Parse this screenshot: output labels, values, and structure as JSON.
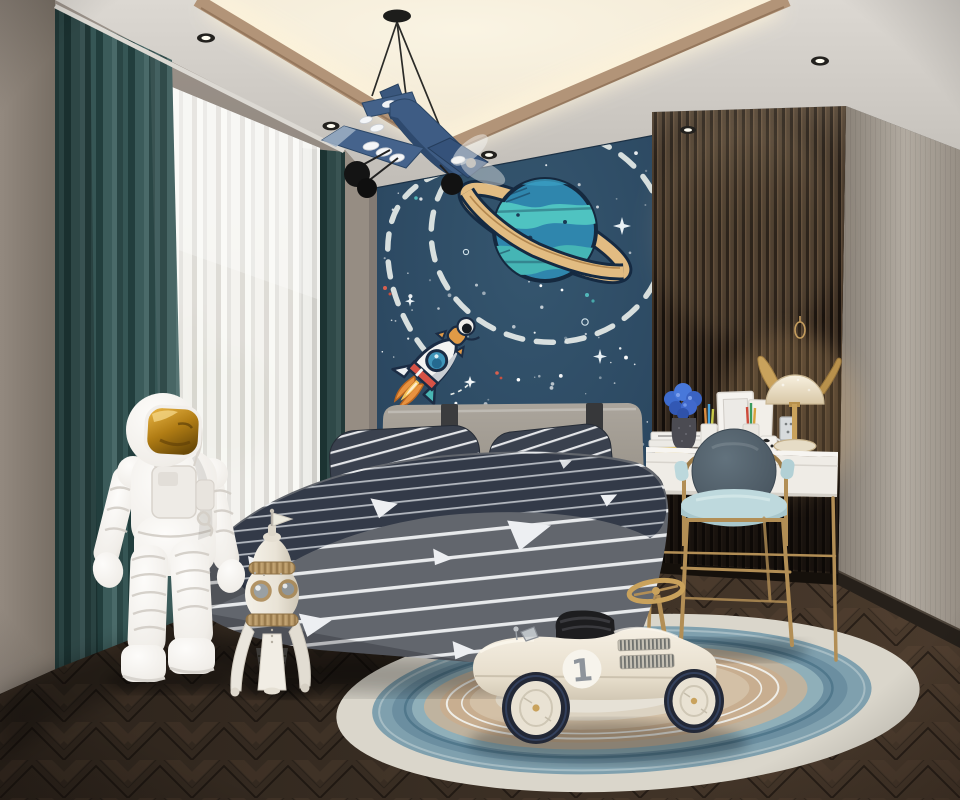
{
  "scene": {
    "type": "interior-3d-render",
    "title": "Space-themed children's bedroom",
    "description": "3D render of a kids bedroom: navy space mural with ringed planet and cartoon rocket behind a grey bed with striped bedding, life-size white astronaut statue with gold visor, cream toy rocket, vintage cream ride-on race car numbered 1 on an oval ringed rug, blue toy-airplane pendant lamp, dark teal and sheer curtains, walnut wood-slat feature wall with white desk, horned mushroom lamp and round-back chair, dark herringbone wood floor, tray ceiling with warm cove lighting.",
    "car": {
      "race_number": "1"
    },
    "mural": {
      "stars": {
        "count": 95,
        "color": "#ffffff"
      }
    },
    "palette": {
      "mural_navy": "#2d4b63",
      "planet_blue": "#2f86ad",
      "planet_teal": "#4fc3c1",
      "ring_tan": "#e2bc82",
      "curtain_teal": "#30504f",
      "sheer_white": "#f2f0ec",
      "slat_walnut": "#413326",
      "left_wall_beige": "#8a8177",
      "right_wall_grey": "#a39c92",
      "ceiling_cream": "#f2ebdb",
      "trim_tan": "#b29478",
      "headboard_grey": "#a09a91",
      "pillow_navy": "#3a414e",
      "duvet_grey": "#62666d",
      "astronaut_white": "#f7f5f2",
      "visor_gold": "#c2861c",
      "car_cream": "#ece4d4",
      "tire_navy": "#232836",
      "frame_gold": "#b28e55",
      "chair_disc_slate": "#53636f",
      "cushion_blue": "#bed9dd",
      "rug_blue": "#6b8ea0",
      "rug_tan": "#c8ae90",
      "floor_brown": "#3b2f26",
      "hydrangea_blue": "#4169cc"
    },
    "objects": [
      {
        "id": "ceiling-cove",
        "label": "Recessed tray ceiling with warm cove light and tan trim"
      },
      {
        "id": "downlights",
        "label": "Recessed ceiling downlights",
        "count": 5
      },
      {
        "id": "airplane-pendant",
        "label": "Blue toy-airplane pendant lamp on black ceiling mount"
      },
      {
        "id": "space-mural",
        "label": "Navy space wall mural with stars and dashed orbits"
      },
      {
        "id": "saturn-planet",
        "label": "Hand-drawn ringed planet with teal bands and tan ring"
      },
      {
        "id": "mural-rocket",
        "label": "Cartoon rocket with riding astronaut and orange flames"
      },
      {
        "id": "teal-curtain-left",
        "label": "Dark teal blackout curtain"
      },
      {
        "id": "sheer-curtain",
        "label": "White sheer curtain over bright window"
      },
      {
        "id": "teal-curtain-right",
        "label": "Dark teal curtain panel beside mural"
      },
      {
        "id": "left-wall",
        "label": "Beige side wall"
      },
      {
        "id": "slat-wall",
        "label": "Dark walnut vertical wood-slat feature wall"
      },
      {
        "id": "right-wall",
        "label": "Grey fabric side wall with dark baseboard"
      },
      {
        "id": "headboard",
        "label": "Grey upholstered headboard with charcoal straps"
      },
      {
        "id": "pillows",
        "label": "Navy striped pillows"
      },
      {
        "id": "duvet",
        "label": "Grey striped duvet with white triangle sails"
      },
      {
        "id": "astronaut-statue",
        "label": "White astronaut statue with gold mirrored visor"
      },
      {
        "id": "toy-rocket",
        "label": "Cream retro toy rocket with brass bands and portholes"
      },
      {
        "id": "ride-on-car",
        "label": "Cream vintage ride-on race car with gold steering wheel"
      },
      {
        "id": "round-rug",
        "label": "Oval rug with organic cream, blue and tan rings"
      },
      {
        "id": "desk",
        "label": "White desk with gold metal legs"
      },
      {
        "id": "desk-chair",
        "label": "Round-back chair, slate disc, pale blue cushion, gold frame"
      },
      {
        "id": "horned-lamp",
        "label": "Cream mushroom lamp with gold horns"
      },
      {
        "id": "hydrangea",
        "label": "Blue hydrangea in dark vase"
      },
      {
        "id": "picture-frames",
        "label": "White picture frames on desk"
      },
      {
        "id": "stationery",
        "label": "Books, pencil cups, mug on desk"
      },
      {
        "id": "wall-outlet",
        "label": "Power outlet on slat wall"
      },
      {
        "id": "floor",
        "label": "Dark herringbone wood floor"
      }
    ]
  }
}
